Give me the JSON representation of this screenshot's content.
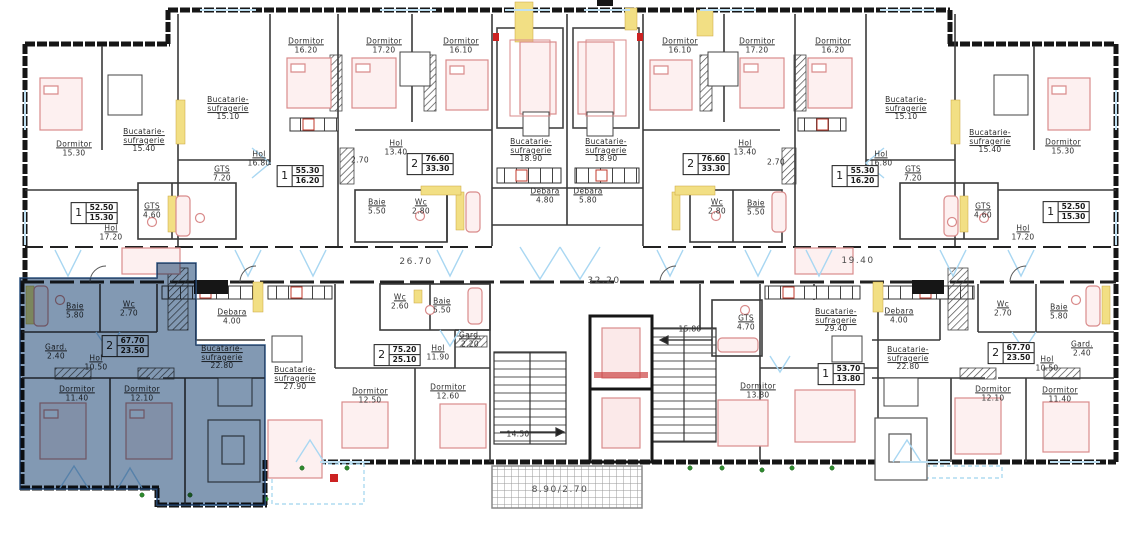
{
  "colors": {
    "wall": "#161616",
    "furniture_pink": "#d98b8b",
    "accent_yellow": "#f2df84",
    "window_blue": "#a9d7f2",
    "highlight_blue": "#8299b3",
    "stove_red": "#c0392b",
    "plant_green": "#2e8b2e"
  },
  "rooms": [
    {
      "name": "Dormitor",
      "area": "15.30",
      "x": 74,
      "y": 149
    },
    {
      "name": "Bucatarie-\nsufragerie",
      "area": "15.40",
      "x": 144,
      "y": 141
    },
    {
      "name": "GTS",
      "area": "4.60",
      "x": 152,
      "y": 211
    },
    {
      "name": "Hol",
      "area": "17.20",
      "x": 111,
      "y": 233
    },
    {
      "name": "Dormitor",
      "area": "16.20",
      "x": 306,
      "y": 46
    },
    {
      "name": "Bucatarie-\nsufragerie",
      "area": "15.10",
      "x": 228,
      "y": 109
    },
    {
      "name": "Hol",
      "area": "16.80",
      "x": 259,
      "y": 159
    },
    {
      "name": "GTS",
      "area": "7.20",
      "x": 222,
      "y": 174
    },
    {
      "name": "",
      "area": "2.70",
      "x": 360,
      "y": 161
    },
    {
      "name": "Dormitor",
      "area": "17.20",
      "x": 384,
      "y": 46
    },
    {
      "name": "Dormitor",
      "area": "16.10",
      "x": 461,
      "y": 46
    },
    {
      "name": "Hol",
      "area": "13.40",
      "x": 396,
      "y": 148
    },
    {
      "name": "Baie",
      "area": "5.50",
      "x": 377,
      "y": 207
    },
    {
      "name": "Wc",
      "area": "2.80",
      "x": 421,
      "y": 207
    },
    {
      "name": "Bucatarie-\nsufragerie",
      "area": "18.90",
      "x": 531,
      "y": 151
    },
    {
      "name": "Debara",
      "area": "4.80",
      "x": 545,
      "y": 196
    },
    {
      "name": "Bucatarie-\nsufragerie",
      "area": "18.90",
      "x": 606,
      "y": 151
    },
    {
      "name": "Debara",
      "area": "5.80",
      "x": 588,
      "y": 196
    },
    {
      "name": "Dormitor",
      "area": "16.10",
      "x": 680,
      "y": 46
    },
    {
      "name": "Dormitor",
      "area": "17.20",
      "x": 757,
      "y": 46
    },
    {
      "name": "Hol",
      "area": "13.40",
      "x": 745,
      "y": 148
    },
    {
      "name": "Baie",
      "area": "5.50",
      "x": 756,
      "y": 208
    },
    {
      "name": "Wc",
      "area": "2.80",
      "x": 717,
      "y": 207
    },
    {
      "name": "",
      "area": "2.70",
      "x": 776,
      "y": 163
    },
    {
      "name": "Dormitor",
      "area": "16.20",
      "x": 833,
      "y": 46
    },
    {
      "name": "Bucatarie-\nsufragerie",
      "area": "15.10",
      "x": 906,
      "y": 109
    },
    {
      "name": "Hol",
      "area": "16.80",
      "x": 881,
      "y": 159
    },
    {
      "name": "GTS",
      "area": "7.20",
      "x": 913,
      "y": 174
    },
    {
      "name": "Bucatarie-\nsufragerie",
      "area": "15.40",
      "x": 990,
      "y": 142
    },
    {
      "name": "Dormitor",
      "area": "15.30",
      "x": 1063,
      "y": 147
    },
    {
      "name": "GTS",
      "area": "4.60",
      "x": 983,
      "y": 211
    },
    {
      "name": "Hol",
      "area": "17.20",
      "x": 1023,
      "y": 233
    },
    {
      "name": "Baie",
      "area": "5.80",
      "x": 75,
      "y": 311
    },
    {
      "name": "Wc",
      "area": "2.70",
      "x": 129,
      "y": 309
    },
    {
      "name": "Debara",
      "area": "4.00",
      "x": 232,
      "y": 317
    },
    {
      "name": "Gard.",
      "area": "2.40",
      "x": 56,
      "y": 352
    },
    {
      "name": "Hol",
      "area": "10.50",
      "x": 96,
      "y": 363
    },
    {
      "name": "Bucatarie-\nsufragerie",
      "area": "22.80",
      "x": 222,
      "y": 358
    },
    {
      "name": "Dormitor",
      "area": "11.40",
      "x": 77,
      "y": 394
    },
    {
      "name": "Dormitor",
      "area": "12.10",
      "x": 142,
      "y": 394
    },
    {
      "name": "Bucatarie-\nsufragerie",
      "area": "27.90",
      "x": 295,
      "y": 379
    },
    {
      "name": "Wc",
      "area": "2.60",
      "x": 400,
      "y": 302
    },
    {
      "name": "Baie",
      "area": "5.50",
      "x": 442,
      "y": 306
    },
    {
      "name": "Hol",
      "area": "11.90",
      "x": 438,
      "y": 353
    },
    {
      "name": "Gard.",
      "area": "2.20",
      "x": 470,
      "y": 340
    },
    {
      "name": "Dormitor",
      "area": "12.50",
      "x": 370,
      "y": 396
    },
    {
      "name": "Dormitor",
      "area": "12.60",
      "x": 448,
      "y": 392
    },
    {
      "name": "",
      "area": "14.50",
      "x": 518,
      "y": 435
    },
    {
      "name": "",
      "area": "15.80",
      "x": 690,
      "y": 330
    },
    {
      "name": "GTS",
      "area": "4.70",
      "x": 746,
      "y": 323
    },
    {
      "name": "Bucatarie-\nsufragerie",
      "area": "29.40",
      "x": 836,
      "y": 321
    },
    {
      "name": "Dormitor",
      "area": "13.80",
      "x": 758,
      "y": 391
    },
    {
      "name": "Debara",
      "area": "4.00",
      "x": 899,
      "y": 316
    },
    {
      "name": "Bucatarie-\nsufragerie",
      "area": "22.80",
      "x": 908,
      "y": 359
    },
    {
      "name": "Wc",
      "area": "2.70",
      "x": 1003,
      "y": 309
    },
    {
      "name": "Baie",
      "area": "5.80",
      "x": 1059,
      "y": 312
    },
    {
      "name": "Hol",
      "area": "10.50",
      "x": 1047,
      "y": 364
    },
    {
      "name": "Gard.",
      "area": "2.40",
      "x": 1082,
      "y": 349
    },
    {
      "name": "Dormitor",
      "area": "12.10",
      "x": 993,
      "y": 394
    },
    {
      "name": "Dormitor",
      "area": "11.40",
      "x": 1060,
      "y": 395
    }
  ],
  "badges": [
    {
      "type": "1",
      "total": "52.50",
      "living": "15.30",
      "x": 94,
      "y": 213
    },
    {
      "type": "1",
      "total": "55.30",
      "living": "16.20",
      "x": 300,
      "y": 176
    },
    {
      "type": "2",
      "total": "76.60",
      "living": "33.30",
      "x": 430,
      "y": 164
    },
    {
      "type": "2",
      "total": "76.60",
      "living": "33.30",
      "x": 706,
      "y": 164
    },
    {
      "type": "1",
      "total": "55.30",
      "living": "16.20",
      "x": 855,
      "y": 176
    },
    {
      "type": "1",
      "total": "52.50",
      "living": "15.30",
      "x": 1066,
      "y": 212
    },
    {
      "type": "2",
      "total": "67.70",
      "living": "23.50",
      "x": 125,
      "y": 346
    },
    {
      "type": "2",
      "total": "75.20",
      "living": "25.10",
      "x": 397,
      "y": 355
    },
    {
      "type": "1",
      "total": "53.70",
      "living": "13.80",
      "x": 841,
      "y": 374
    },
    {
      "type": "2",
      "total": "67.70",
      "living": "23.50",
      "x": 1011,
      "y": 353
    }
  ],
  "dims": [
    {
      "text": "26.70",
      "x": 416,
      "y": 262
    },
    {
      "text": "32.20",
      "x": 604,
      "y": 281
    },
    {
      "text": "19.40",
      "x": 858,
      "y": 261
    },
    {
      "text": "8.90/2.70",
      "x": 560,
      "y": 490
    }
  ]
}
